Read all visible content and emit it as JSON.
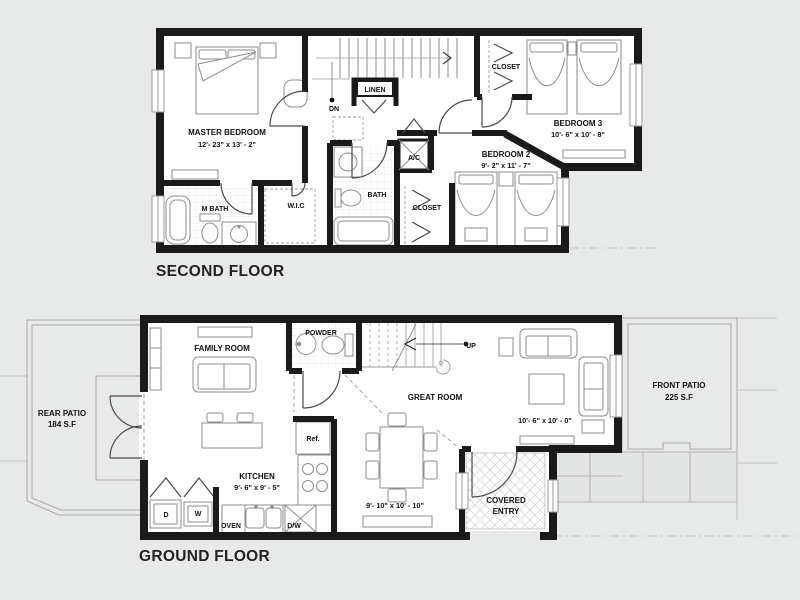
{
  "colors": {
    "background": "#e8e9e9",
    "wall": "#1a1a1a",
    "furniture_line": "#8e8e8e",
    "text": "#111111"
  },
  "second_floor": {
    "title": "SECOND FLOOR",
    "master_bedroom": {
      "label": "MASTER BEDROOM",
      "dims": "12'- 23\" x 13' - 2\""
    },
    "m_bath": {
      "label": "M BATH"
    },
    "wic": {
      "label": "W.I.C"
    },
    "bath": {
      "label": "BATH"
    },
    "linen": {
      "label": "LINEN"
    },
    "stairs_down": {
      "label": "DN"
    },
    "ac": {
      "label": "A/C"
    },
    "closet_bedroom3": {
      "label": "CLOSET"
    },
    "closet_bedroom2": {
      "label": "CLOSET"
    },
    "bedroom2": {
      "label": "BEDROOM 2",
      "dims": "9'- 2\" x 11' - 7\""
    },
    "bedroom3": {
      "label": "BEDROOM 3",
      "dims": "10'- 6\" x 10' - 8\""
    }
  },
  "ground_floor": {
    "title": "GROUND FLOOR",
    "family_room": {
      "label": "FAMILY ROOM"
    },
    "powder": {
      "label": "POWDER"
    },
    "stairs_up": {
      "label": "UP"
    },
    "great_room": {
      "label": "GREAT ROOM",
      "dims": "10'- 6\" x 10' - 0\"",
      "dining_dims": "9'- 10\" x 10' - 10\""
    },
    "kitchen": {
      "label": "KITCHEN",
      "dims": "9'- 6\" x 9' - 5\""
    },
    "fridge": {
      "label": "Ref."
    },
    "oven": {
      "label": "OVEN"
    },
    "dishwasher": {
      "label": "D/W"
    },
    "dryer": {
      "label": "D"
    },
    "washer": {
      "label": "W"
    },
    "covered_entry": {
      "label_line1": "COVERED",
      "label_line2": "ENTRY"
    },
    "rear_patio": {
      "label": "REAR PATIO",
      "area": "184 S.F"
    },
    "front_patio": {
      "label": "FRONT PATIO",
      "area": "225 S.F"
    }
  }
}
